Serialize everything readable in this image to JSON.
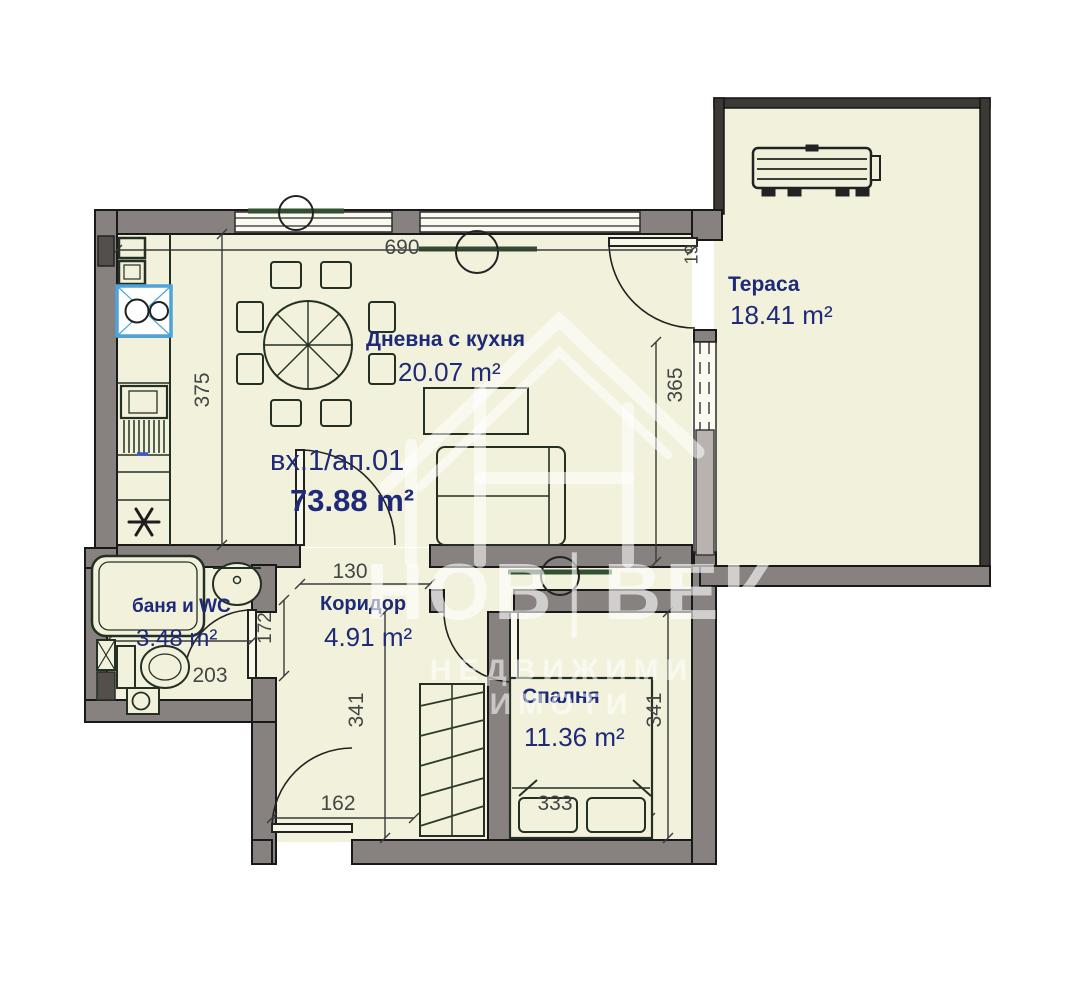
{
  "watermark": {
    "left": "НОВ",
    "separator": "│",
    "right": "ВЕК",
    "subtitle": "НЕДВИЖИМИ ИМОТИ"
  },
  "apartment": {
    "label": "вх.1/ап.01",
    "area": "73.88 m²"
  },
  "rooms": {
    "living": {
      "name": "Дневна с кухня",
      "area": "20.07 m²"
    },
    "terrace": {
      "name": "Тераса",
      "area": "18.41 m²"
    },
    "bath": {
      "name": "баня и WC",
      "area": "3.48 m²"
    },
    "corridor": {
      "name": "Коридор",
      "area": "4.91 m²"
    },
    "bedroom": {
      "name": "Спалня",
      "area": "11.36 m²"
    }
  },
  "dimensions": {
    "top_width": "690",
    "entry_side": "19",
    "living_depth": "375",
    "terrace_depth": "365",
    "corridor_opening": "130",
    "bath_door": "172",
    "bath_width": "203",
    "hall_depth": "341",
    "bedroom_depth": "341",
    "hall_width": "162",
    "bed_width": "333"
  },
  "colors": {
    "floor": "#f2f2dc",
    "wall": "#87827f",
    "label_navy": "#1e2a78",
    "dimension_gray": "#454545",
    "lens_green": "#334f31",
    "sink_blue": "#4ea3d8",
    "watermark_white": "rgba(255,255,255,0.6)"
  }
}
